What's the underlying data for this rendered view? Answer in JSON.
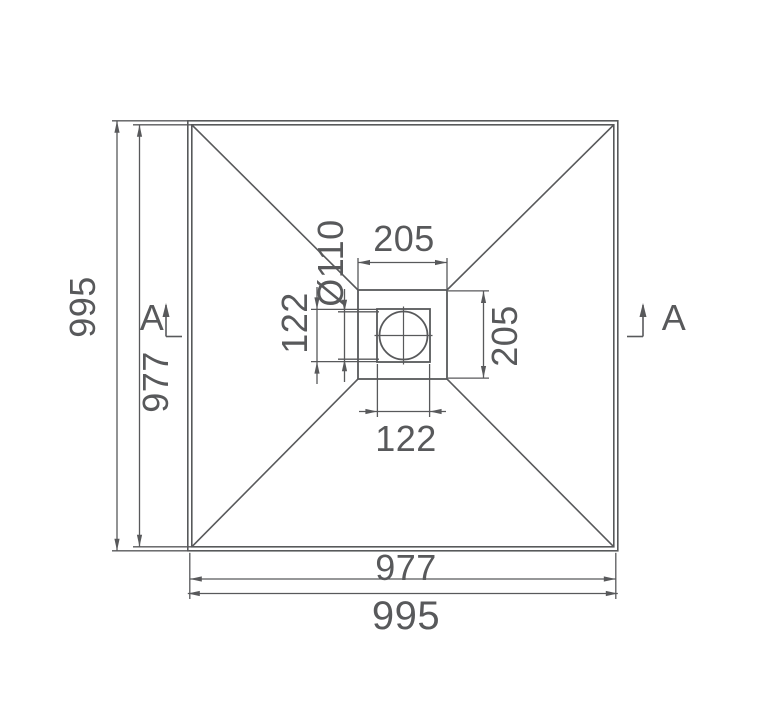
{
  "drawing": {
    "labels": {
      "dim_995_left": "995",
      "dim_977_left": "977",
      "dim_205_top": "205",
      "dim_205_right": "205",
      "dim_122_left": "122",
      "dim_diameter": "Ø110",
      "dim_122_bottom": "122",
      "dim_977_bottom": "977",
      "dim_995_bottom": "995",
      "section_a_left": "A",
      "section_a_right": "A"
    },
    "colors": {
      "line": "#58595b",
      "background": "#ffffff"
    }
  }
}
